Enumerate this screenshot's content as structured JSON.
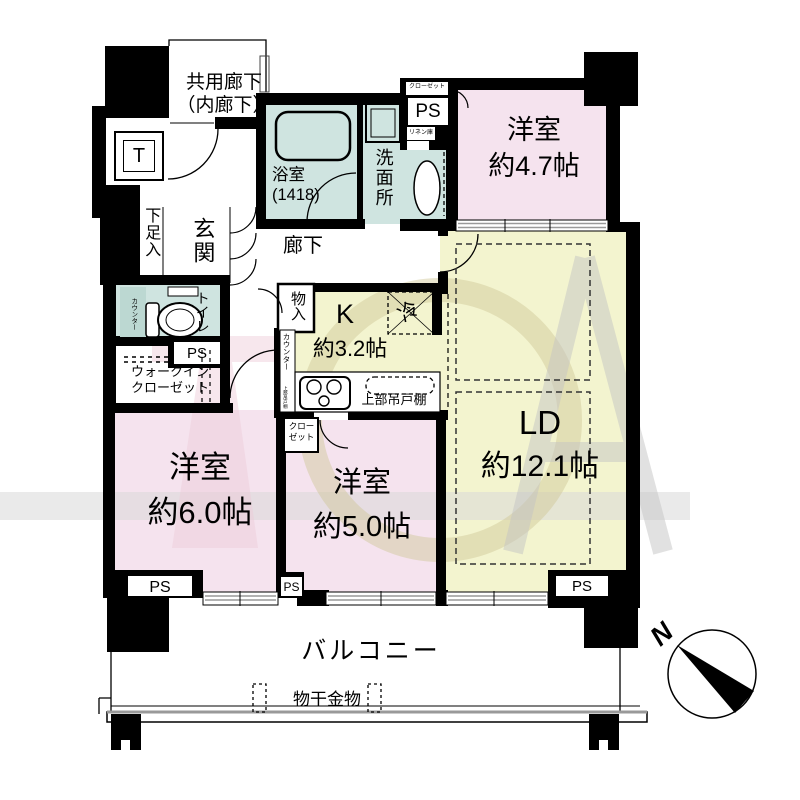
{
  "rooms": {
    "western_4_7": {
      "name": "洋室",
      "size": "約4.7帖"
    },
    "western_6_0": {
      "name": "洋室",
      "size": "約6.0帖"
    },
    "western_5_0": {
      "name": "洋室",
      "size": "約5.0帖"
    },
    "living_dining": {
      "name": "LD",
      "size": "約12.1帖"
    },
    "kitchen": {
      "name": "K",
      "size": "約3.2帖"
    },
    "bath": {
      "name": "浴室",
      "size": "(1418)"
    }
  },
  "labels": {
    "common_corridor_line1": "共用廊下",
    "common_corridor_line2": "（内廊下）",
    "trunk_room": "T",
    "washroom": "洗面所",
    "closet": "クローゼット",
    "linen_cabinet": "リネン庫",
    "pipe_space": "PS",
    "entrance": "玄関",
    "shoe_cabinet": "下足入",
    "hallway": "廊下",
    "toilet": "トイレ",
    "counter": "カウンター",
    "upper_cabinet": "上部吊戸棚",
    "walkin_closet_line1": "ウォークイン",
    "walkin_closet_line2": "クローゼット",
    "storage": "物入",
    "refrigerator": "冷",
    "closet_small_line1": "クロー",
    "closet_small_line2": "ゼット",
    "balcony": "バルコニー",
    "laundry_hardware": "物干金物",
    "compass_north": "N"
  },
  "colors": {
    "wall": "#000000",
    "room_pink": "#f5e3ee",
    "room_teal": "#cfe4e0",
    "room_yellow": "#f3f4cf",
    "fixture_teal": "#bcd8d2",
    "watermark_pink": "#eec9d8",
    "watermark_gray": "#d8d8d8",
    "watermark_tan": "#cfc695",
    "window_gray": "#999999"
  }
}
